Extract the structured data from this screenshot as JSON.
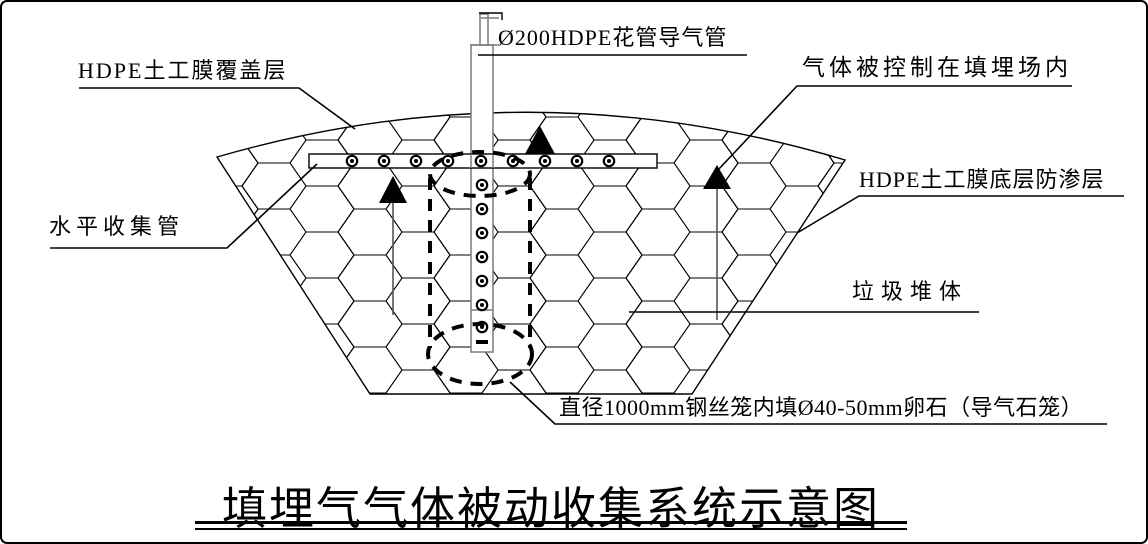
{
  "diagram": {
    "title": "填埋气气体被动收集系统示意图",
    "labels": {
      "vent_pipe": "Ø200HDPE花管导气管",
      "cover_layer": "HDPE土工膜覆盖层",
      "gas_contained": "气体被控制在填埋场内",
      "liner_layer": "HDPE土工膜底层防渗层",
      "horizontal_pipe": "水平收集管",
      "waste_body": "垃圾堆体",
      "stone_cage": "直径1000mm钢丝笼内填Ø40-50mm卵石（导气石笼）"
    },
    "colors": {
      "line": "#000000",
      "pipe_gray": "#7a7a7a",
      "background": "#ffffff"
    }
  }
}
